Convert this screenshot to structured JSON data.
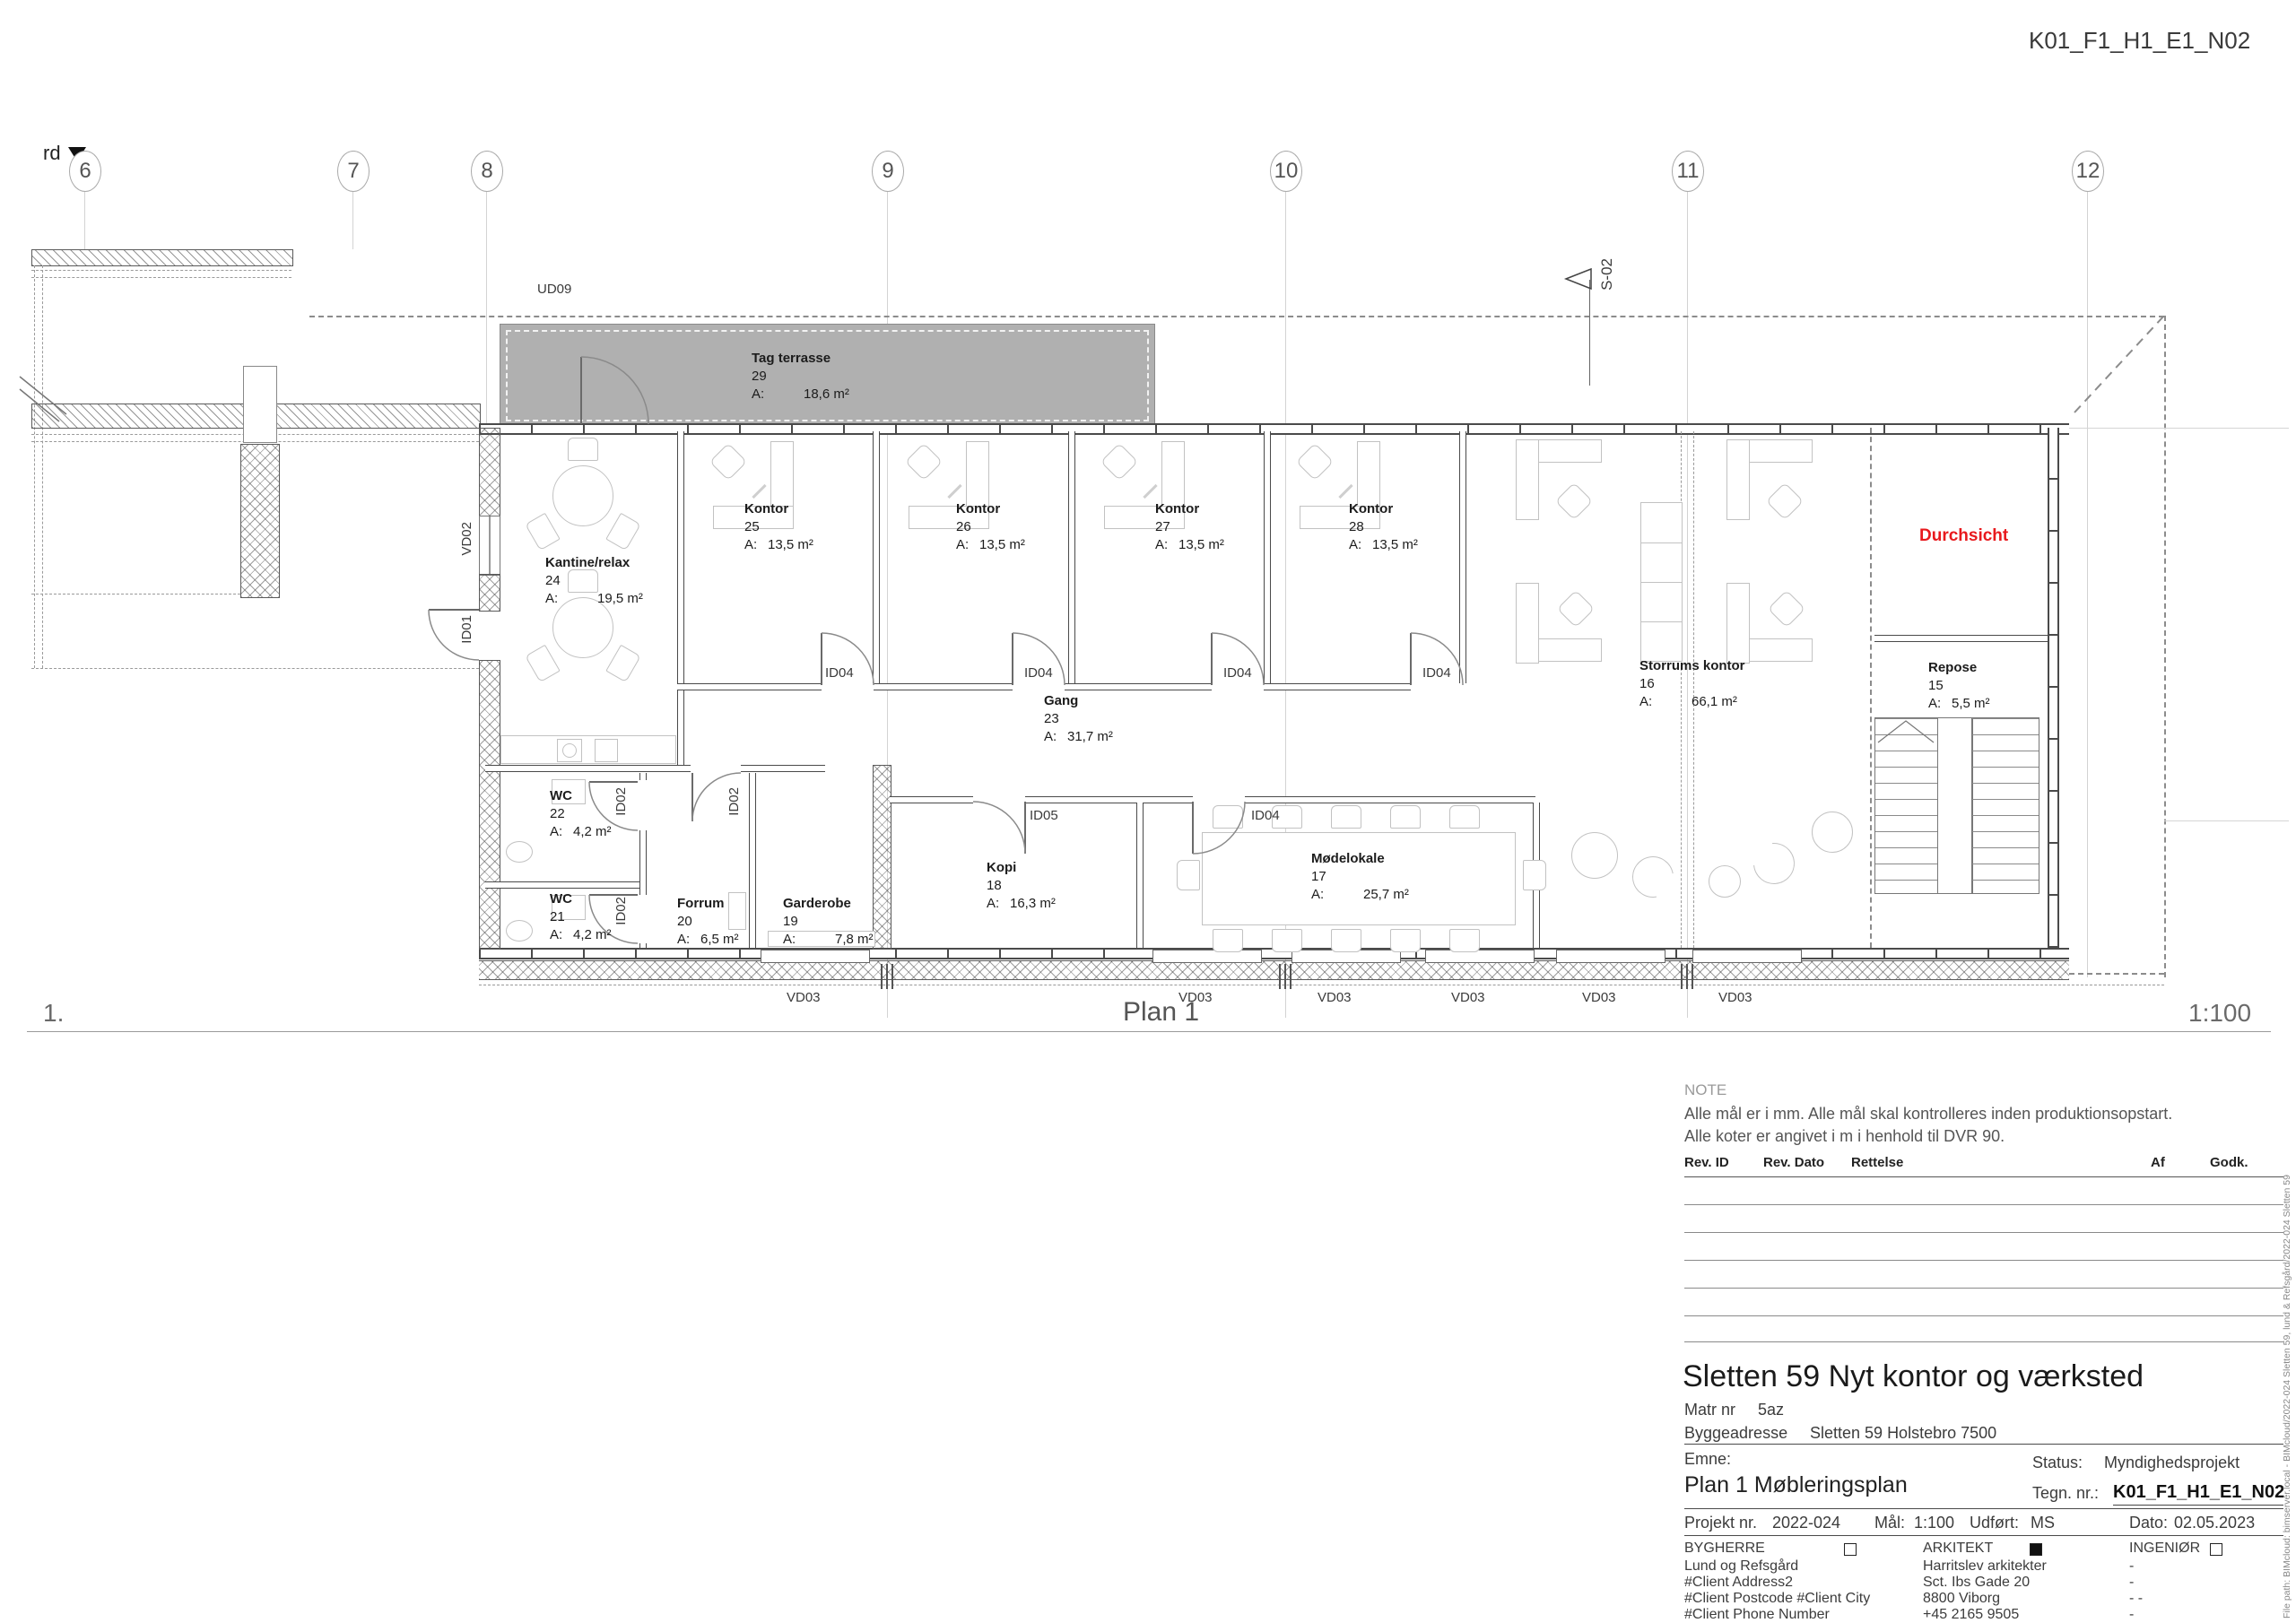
{
  "header": {
    "drawing_no": "K01_F1_H1_E1_N02"
  },
  "plan": {
    "title": "Plan 1",
    "scale": "1:100",
    "index": "1.",
    "grid_numbers": [
      "6",
      "7",
      "8",
      "9",
      "10",
      "11",
      "12"
    ],
    "markers": {
      "rd": "rd",
      "section": "S-02"
    }
  },
  "labels": {
    "area_prefix": "A:",
    "area_unit": "m²",
    "durchsicht": "Durchsicht"
  },
  "rooms": [
    {
      "name": "Tag terrasse",
      "no": "29",
      "area": "18,6"
    },
    {
      "name": "Kantine/relax",
      "no": "24",
      "area": "19,5"
    },
    {
      "name": "Kontor",
      "no": "25",
      "area": "13,5"
    },
    {
      "name": "Kontor",
      "no": "26",
      "area": "13,5"
    },
    {
      "name": "Kontor",
      "no": "27",
      "area": "13,5"
    },
    {
      "name": "Kontor",
      "no": "28",
      "area": "13,5"
    },
    {
      "name": "Storrums kontor",
      "no": "16",
      "area": "66,1"
    },
    {
      "name": "Repose",
      "no": "15",
      "area": "5,5"
    },
    {
      "name": "Gang",
      "no": "23",
      "area": "31,7"
    },
    {
      "name": "WC",
      "no": "22",
      "area": "4,2"
    },
    {
      "name": "WC",
      "no": "21",
      "area": "4,2"
    },
    {
      "name": "Forrum",
      "no": "20",
      "area": "6,5"
    },
    {
      "name": "Garderobe",
      "no": "19",
      "area": "7,8"
    },
    {
      "name": "Kopi",
      "no": "18",
      "area": "16,3"
    },
    {
      "name": "Mødelokale",
      "no": "17",
      "area": "25,7"
    }
  ],
  "door_tags": {
    "id01": "ID01",
    "id02": "ID02",
    "id04": "ID04",
    "id05": "ID05",
    "vd02": "VD02",
    "vd03": "VD03",
    "ud09": "UD09"
  },
  "title_block": {
    "note_title": "NOTE",
    "note_line1": "Alle mål er i mm. Alle mål skal kontrolleres inden produktionsopstart.",
    "note_line2": "Alle koter er angivet i m i henhold til DVR 90.",
    "rev_headers": {
      "id": "Rev. ID",
      "dato": "Rev. Dato",
      "rettelse": "Rettelse",
      "af": "Af",
      "godk": "Godk."
    },
    "project_title": "Sletten 59 Nyt kontor og værksted",
    "matr_label": "Matr nr",
    "matr_value": "5az",
    "bygge_label": "Byggeadresse",
    "bygge_value": "Sletten 59 Holstebro 7500",
    "emne_label": "Emne:",
    "emne_value": "Plan 1 Møbleringsplan",
    "status_label": "Status:",
    "status_value": "Myndighedsprojekt",
    "tegn_label": "Tegn. nr.:",
    "tegn_value": "K01_F1_H1_E1_N02",
    "projekt_label": "Projekt nr.",
    "projekt_value": "2022-024",
    "maal_label": "Mål:",
    "maal_value": "1:100",
    "udfoert_label": "Udført:",
    "udfoert_value": "MS",
    "dato_label": "Dato:",
    "dato_value": "02.05.2023",
    "parties": [
      {
        "role": "BYGHERRE",
        "lines": [
          "Lund og Refsgård",
          "#Client Address2",
          "#Client Postcode #Client City",
          "#Client Phone Number"
        ]
      },
      {
        "role": "ARKITEKT",
        "lines": [
          "Harritslev arkitekter",
          "Sct. Ibs Gade 20",
          "8800 Viborg",
          "+45 2165 9505"
        ]
      },
      {
        "role": "INGENIØR",
        "lines": [
          "-",
          "-",
          "- -",
          "-"
        ]
      }
    ],
    "file_path": "File path: BIMcloud: bimserver.local - BIMcloud/2022-024 Sletten 59, lund & Refsgård/2022-024 Sletten 59"
  }
}
